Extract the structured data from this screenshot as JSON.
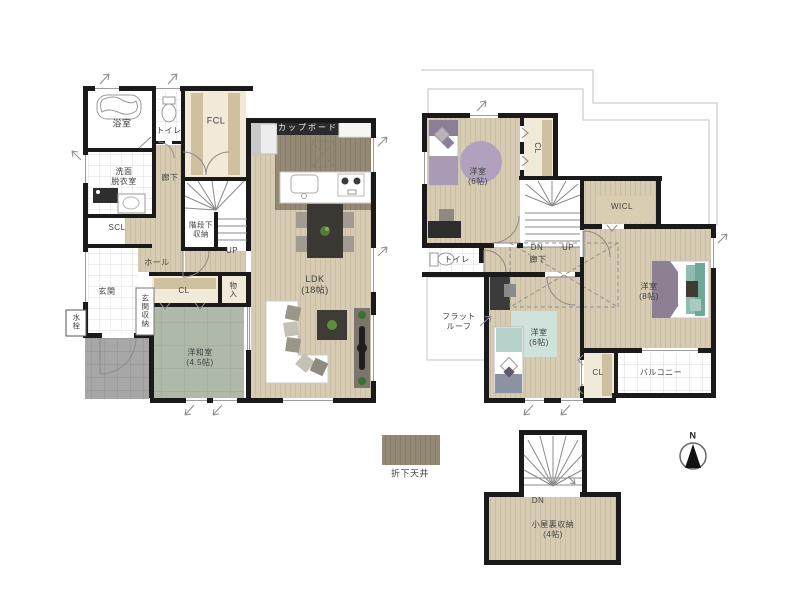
{
  "floor1": {
    "bath": "浴室",
    "toilet": "トイレ",
    "fcl": "FCL",
    "washroom": "洗面\n脱衣室",
    "corridor": "廊下",
    "scl": "SCL",
    "under_stairs": "階段下\n収納",
    "up": "UP",
    "hall": "ホール",
    "entrance": "玄関",
    "entrance_storage": "玄関収納",
    "faucet": "水栓",
    "closet": "CL",
    "storage_small": "物入",
    "tatami_room": "洋和室\n(4.5帖)",
    "ldk": "LDK\n(18帖)",
    "cupboard": "カップボード"
  },
  "floor2": {
    "bedroom_a": "洋室\n(6帖)",
    "closet_a": "CL",
    "wicl": "WICL",
    "dn": "DN",
    "up": "UP",
    "corridor": "廊下",
    "toilet": "トイレ",
    "flat_roof": "フラット\nルーフ",
    "bedroom_b": "洋室\n(6帖)",
    "closet_b": "CL",
    "bedroom_main": "洋室\n(8帖)",
    "balcony": "バルコニー"
  },
  "attic": {
    "dn": "DN",
    "storage": "小屋裏収納\n(4帖)"
  },
  "legend": {
    "dropped_ceiling": "折下天井"
  },
  "compass": {
    "north": "N"
  },
  "colors": {
    "wall": "#1a1a1a",
    "wood_floor": "#d7ccb3",
    "dropped_ceiling": "#948974",
    "tatami_green": "#aeb9a9",
    "porch_gray": "#a7a7a7",
    "closet_cream": "#f1ead9",
    "closet_shelf": "#cfc09f",
    "bed_purple": "#8c7e97",
    "rug_purple": "#b1a1bf",
    "bed_teal": "#8fbcae",
    "rug_mint": "#cfe2dc",
    "furniture_dark": "#3b3833"
  }
}
